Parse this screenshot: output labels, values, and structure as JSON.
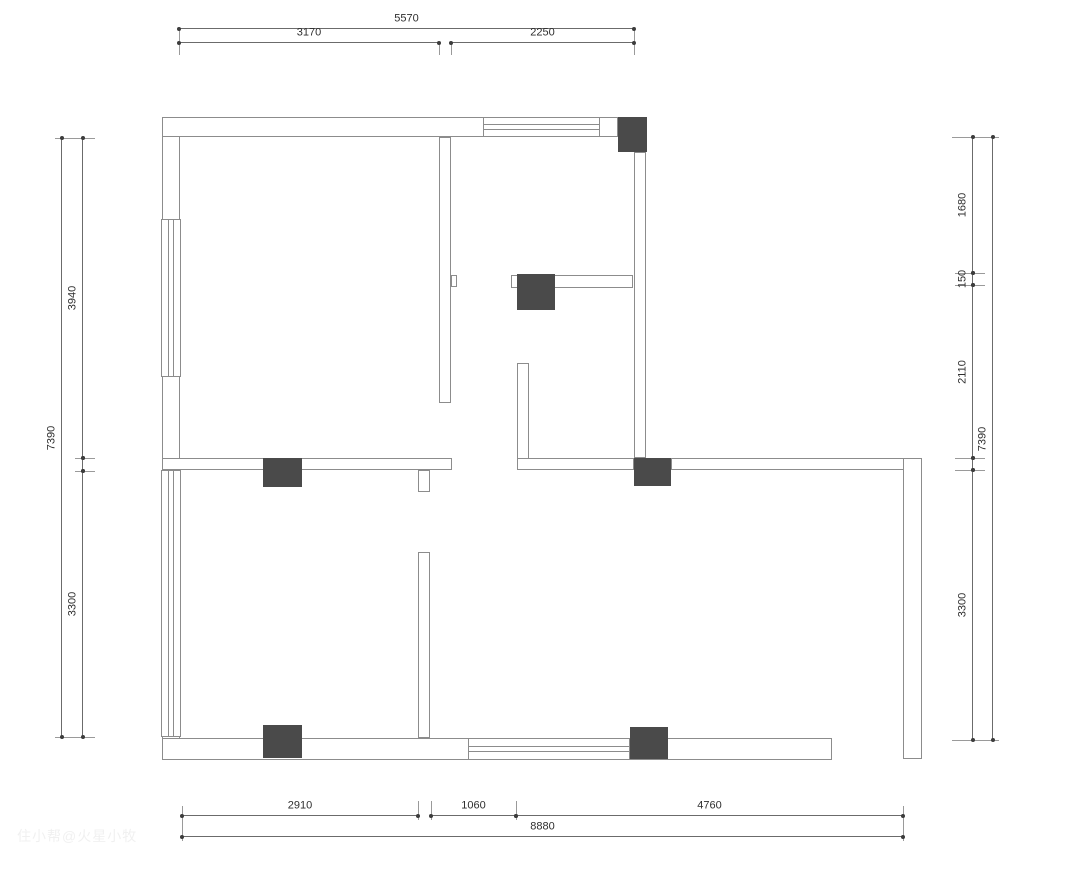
{
  "canvas": {
    "width": 1065,
    "height": 870,
    "bg": "#ffffff",
    "wall_stroke": "#8c8c8c",
    "column_fill": "#4a4a4a",
    "dim_stroke": "#6b6b6b",
    "dim_text_color": "#2e2e2e"
  },
  "watermark": {
    "text": "住小帮@火星小牧"
  },
  "plan": {
    "walls": [
      {
        "x": 162,
        "y": 117,
        "w": 18,
        "h": 643
      },
      {
        "x": 162,
        "y": 117,
        "w": 456,
        "h": 20
      },
      {
        "x": 162,
        "y": 738,
        "w": 670,
        "h": 22
      },
      {
        "x": 162,
        "y": 458,
        "w": 290,
        "h": 12
      },
      {
        "x": 418,
        "y": 470,
        "w": 12,
        "h": 22
      },
      {
        "x": 439,
        "y": 137,
        "w": 12,
        "h": 266
      },
      {
        "x": 451,
        "y": 275,
        "w": 6,
        "h": 12
      },
      {
        "x": 634,
        "y": 152,
        "w": 12,
        "h": 306
      },
      {
        "x": 511,
        "y": 275,
        "w": 122,
        "h": 13
      },
      {
        "x": 517,
        "y": 363,
        "w": 12,
        "h": 107
      },
      {
        "x": 517,
        "y": 458,
        "w": 117,
        "h": 12
      },
      {
        "x": 671,
        "y": 458,
        "w": 251,
        "h": 12
      },
      {
        "x": 903,
        "y": 458,
        "w": 19,
        "h": 301
      },
      {
        "x": 418,
        "y": 552,
        "w": 12,
        "h": 186
      }
    ],
    "columns": [
      {
        "x": 618,
        "y": 117,
        "w": 29,
        "h": 35
      },
      {
        "x": 517,
        "y": 274,
        "w": 38,
        "h": 36
      },
      {
        "x": 634,
        "y": 458,
        "w": 37,
        "h": 28
      },
      {
        "x": 630,
        "y": 727,
        "w": 38,
        "h": 32
      },
      {
        "x": 263,
        "y": 725,
        "w": 39,
        "h": 33
      },
      {
        "x": 263,
        "y": 458,
        "w": 39,
        "h": 29
      }
    ],
    "windows": [
      {
        "x": 483,
        "y": 117,
        "w": 117,
        "h": 20,
        "orient": "h"
      },
      {
        "x": 161,
        "y": 219,
        "w": 20,
        "h": 158,
        "orient": "v"
      },
      {
        "x": 161,
        "y": 470,
        "w": 20,
        "h": 267,
        "orient": "v"
      },
      {
        "x": 468,
        "y": 738,
        "w": 162,
        "h": 22,
        "orient": "h"
      }
    ],
    "extensions": [
      {
        "x1": 179,
        "y1": 28,
        "x2": 179,
        "y2": 55
      },
      {
        "x1": 439,
        "y1": 42,
        "x2": 439,
        "y2": 55
      },
      {
        "x1": 451,
        "y1": 42,
        "x2": 451,
        "y2": 55
      },
      {
        "x1": 634,
        "y1": 28,
        "x2": 634,
        "y2": 55
      },
      {
        "x1": 182,
        "y1": 806,
        "x2": 182,
        "y2": 841
      },
      {
        "x1": 418,
        "y1": 801,
        "x2": 418,
        "y2": 820
      },
      {
        "x1": 431,
        "y1": 801,
        "x2": 431,
        "y2": 820
      },
      {
        "x1": 516,
        "y1": 801,
        "x2": 516,
        "y2": 820
      },
      {
        "x1": 903,
        "y1": 806,
        "x2": 903,
        "y2": 841
      },
      {
        "x1": 55,
        "y1": 138,
        "x2": 95,
        "y2": 138
      },
      {
        "x1": 75,
        "y1": 458,
        "x2": 95,
        "y2": 458
      },
      {
        "x1": 75,
        "y1": 471,
        "x2": 95,
        "y2": 471
      },
      {
        "x1": 55,
        "y1": 737,
        "x2": 95,
        "y2": 737
      },
      {
        "x1": 952,
        "y1": 137,
        "x2": 999,
        "y2": 137
      },
      {
        "x1": 955,
        "y1": 273,
        "x2": 985,
        "y2": 273
      },
      {
        "x1": 955,
        "y1": 285,
        "x2": 985,
        "y2": 285
      },
      {
        "x1": 955,
        "y1": 458,
        "x2": 985,
        "y2": 458
      },
      {
        "x1": 955,
        "y1": 470,
        "x2": 985,
        "y2": 470
      },
      {
        "x1": 952,
        "y1": 740,
        "x2": 999,
        "y2": 740
      }
    ],
    "dimensions": [
      {
        "orient": "h",
        "y": 28,
        "x1": 179,
        "x2": 634,
        "label": "5570"
      },
      {
        "orient": "h",
        "y": 42,
        "x1": 179,
        "x2": 439,
        "label": "3170"
      },
      {
        "orient": "h",
        "y": 42,
        "x1": 451,
        "x2": 634,
        "label": "2250"
      },
      {
        "orient": "h",
        "y": 815,
        "x1": 182,
        "x2": 418,
        "label": "2910"
      },
      {
        "orient": "h",
        "y": 815,
        "x1": 431,
        "x2": 516,
        "label": "1060"
      },
      {
        "orient": "h",
        "y": 815,
        "x1": 516,
        "x2": 903,
        "label": "4760"
      },
      {
        "orient": "h",
        "y": 836,
        "x1": 182,
        "x2": 903,
        "label": "8880"
      },
      {
        "orient": "v",
        "x": 61,
        "y1": 138,
        "y2": 737,
        "label": "7390"
      },
      {
        "orient": "v",
        "x": 82,
        "y1": 138,
        "y2": 458,
        "label": "3940"
      },
      {
        "orient": "v",
        "x": 82,
        "y1": 458,
        "y2": 471,
        "label": ""
      },
      {
        "orient": "v",
        "x": 82,
        "y1": 471,
        "y2": 737,
        "label": "3300"
      },
      {
        "orient": "v",
        "x": 972,
        "y1": 137,
        "y2": 273,
        "label": "1680"
      },
      {
        "orient": "v",
        "x": 972,
        "y1": 273,
        "y2": 285,
        "label": "150"
      },
      {
        "orient": "v",
        "x": 972,
        "y1": 285,
        "y2": 458,
        "label": "2110"
      },
      {
        "orient": "v",
        "x": 972,
        "y1": 458,
        "y2": 470,
        "label": ""
      },
      {
        "orient": "v",
        "x": 972,
        "y1": 470,
        "y2": 740,
        "label": "3300"
      },
      {
        "orient": "v",
        "x": 992,
        "y1": 137,
        "y2": 740,
        "label": "7390"
      }
    ]
  }
}
